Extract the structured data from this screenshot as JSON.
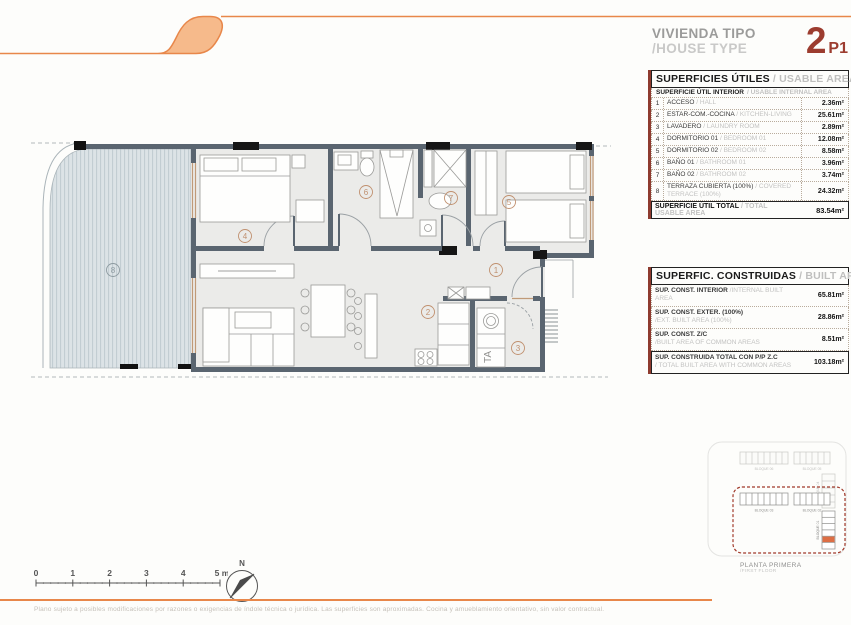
{
  "header": {
    "title_es": "VIVIENDA TIPO",
    "title_en": "/HOUSE TYPE",
    "unit_number": "2",
    "unit_floor": "P1"
  },
  "usable_table": {
    "title_es": "SUPERFICIES ÚTILES",
    "title_en": "/ USABLE AREA",
    "subheader_es": "SUPERFICIE ÚTIL INTERIOR",
    "subheader_en": "/ USABLE INTERNAL AREA",
    "rows": [
      {
        "num": "1",
        "name_es": "ACCESO",
        "name_en": "/ HALL",
        "area": "2.36m²"
      },
      {
        "num": "2",
        "name_es": "ESTAR-COM.-COCINA",
        "name_en": "/ KITCHEN-LIVING",
        "area": "25.61m²"
      },
      {
        "num": "3",
        "name_es": "LAVADERO",
        "name_en": "/ LAUNDRY ROOM",
        "area": "2.89m²"
      },
      {
        "num": "4",
        "name_es": "DORMITORIO 01",
        "name_en": "/ BEDROOM 01",
        "area": "12.08m²"
      },
      {
        "num": "5",
        "name_es": "DORMITORIO 02",
        "name_en": "/ BEDROOM 02",
        "area": "8.58m²"
      },
      {
        "num": "6",
        "name_es": "BAÑO 01",
        "name_en": "/ BATHROOM 01",
        "area": "3.96m²"
      },
      {
        "num": "7",
        "name_es": "BAÑO 02",
        "name_en": "/ BATHROOM 02",
        "area": "3.74m²"
      },
      {
        "num": "8",
        "name_es": "TERRAZA CUBIERTA (100%)",
        "name_en": "/ COVERED TERRACE (100%)",
        "area": "24.32m²"
      }
    ],
    "total_es": "SUPERFICIE ÚTIL TOTAL",
    "total_en": "/ TOTAL USABLE AREA",
    "total_value": "83.54m²"
  },
  "built_table": {
    "title_es": "SUPERFIC. CONSTRUIDAS",
    "title_en": "/ BUILT AREA",
    "rows": [
      {
        "label_es": "SUP. CONST. INTERIOR",
        "label_en": "/INTERNAL BUILT AREA",
        "value": "65.81m²"
      },
      {
        "label_es": "SUP. CONST. EXTER. (100%)",
        "label_en": "/EXT. BUILT AREA (100%)",
        "value": "28.86m²"
      },
      {
        "label_es": "SUP. CONST. Z/C",
        "label_en": "/BUILT AREA OF COMMON AREAS",
        "value": "8.51m²"
      }
    ],
    "total_es": "SUP. CONSTRUIDA TOTAL CON P/P Z.C",
    "total_en": "/ TOTAL BUILT AREA WITH COMMON AREAS",
    "total_value": "103.18m²"
  },
  "plan": {
    "room_numbers": [
      "1",
      "2",
      "3",
      "4",
      "5",
      "6",
      "7",
      "8"
    ],
    "appliance_label": "TA"
  },
  "key_plan": {
    "faded_blocks": [
      "BLOQUE 06",
      "BLOQUE 05",
      "BLOQUE 04"
    ],
    "blocks": [
      "BLOQUE 03",
      "BLOQUE 02",
      "BLOQUE 01"
    ],
    "floor_es": "PLANTA PRIMERA",
    "floor_en": "/FIRST FLOOR"
  },
  "scale_bar": {
    "labels": [
      "0",
      "1",
      "2",
      "3",
      "4",
      "5 m"
    ]
  },
  "north": {
    "label": "N"
  },
  "footer": {
    "disclaimer": "Plano sujeto a posibles modificaciones por razones o exigencias de índole técnica o jurídica. Las superficies son aproximadas. Cocina y amueblamiento orientativo, sin valor contractual."
  },
  "colors": {
    "accent_orange": "#E8874A",
    "brand_red": "#9C3C2F",
    "wall": "#5A6570",
    "highlight_unit": "#DD6E44"
  }
}
